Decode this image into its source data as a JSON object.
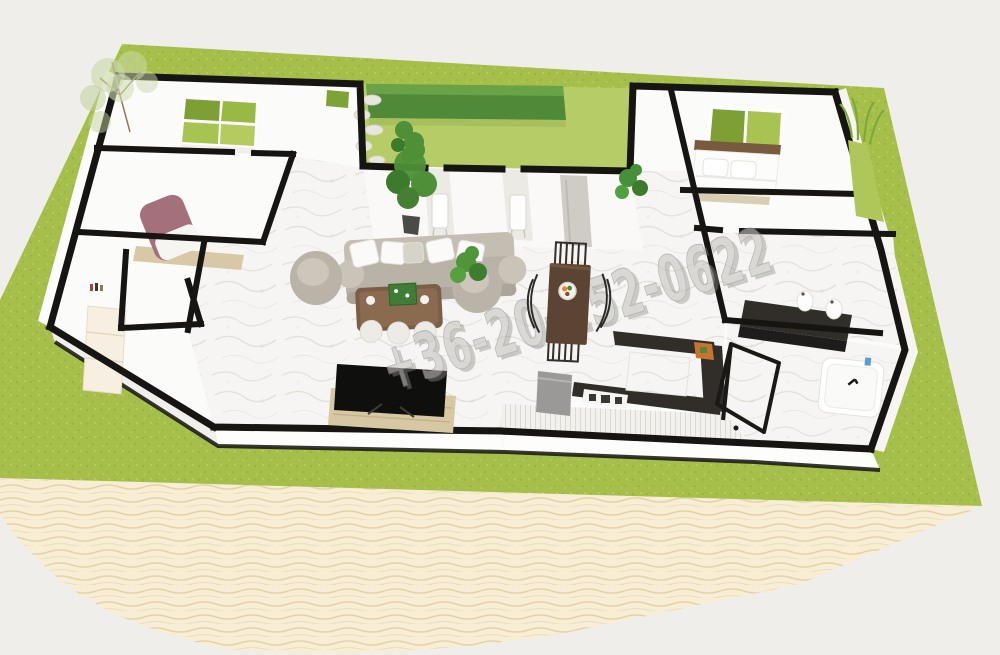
{
  "scene": {
    "title": "3d-floorplan-render",
    "watermark": {
      "text": "+36-20-252-0622"
    },
    "colors": {
      "background": "#efeeeb",
      "grass": "#a6bf4b",
      "grass_speckle_dark": "#8ea93f",
      "grass_speckle_light": "#c2d56e",
      "courtyard_grass": "#b6cc66",
      "hedge": "#4f8a38",
      "hedge_light": "#6da449",
      "sand": "#f7eed5",
      "sand_ripple": "#e6d2a8",
      "wall_black": "#161512",
      "wall_white": "#fdfdfc",
      "floor_white": "#fbfbfa",
      "marble_base": "#f6f5f3",
      "marble_vein": "#dedbd6",
      "sofa_gray": "#b8b2a7",
      "pillow_white": "#fbfaf8",
      "mauve_chair": "#a4707b",
      "desk_wood": "#d8c8a6",
      "coffee_table_wood": "#7b5e46",
      "tray_green": "#3f7d36",
      "tv_black": "#0f0f0e",
      "tv_stand_wood": "#d8c7a3",
      "dining_table_wood": "#5b4433",
      "counter_dark": "#312e2a",
      "fridge_gray": "#9a9997",
      "cutting_board_orange": "#c8742f",
      "window_green_dark": "#7d9f33",
      "window_green_light": "#a9c353",
      "plant_green": "#4e8f38",
      "headboard_wood": "#7a5a3f",
      "bench_tan": "#d9cdb2",
      "pantry_cream": "#f7f0e2",
      "watermark_fill": "#c6c5c2",
      "watermark_shadow": "#8e8d8a"
    }
  }
}
